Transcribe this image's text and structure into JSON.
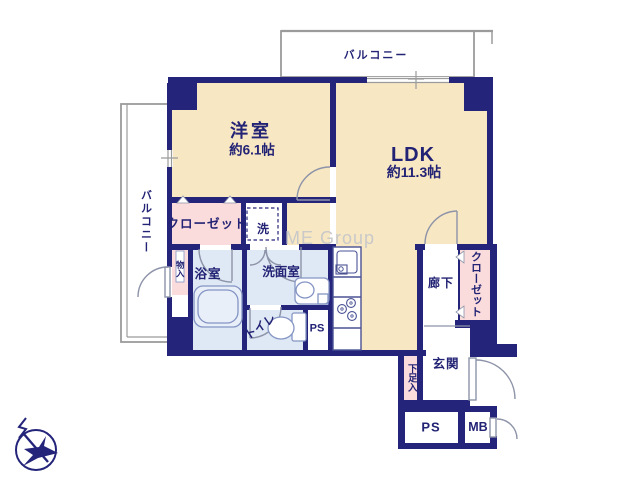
{
  "floorplan": {
    "rooms": {
      "western_room": {
        "label": "洋室",
        "size": "約6.1帖"
      },
      "ldk": {
        "label": "LDK",
        "size": "約11.3帖"
      },
      "balcony_top": {
        "label": "バルコニー"
      },
      "balcony_left": {
        "label": "バルコニー"
      },
      "closet_bedroom": {
        "label": "クローゼット"
      },
      "laundry": {
        "label": "洗"
      },
      "washroom": {
        "label": "洗面室"
      },
      "bathroom": {
        "label": "浴室"
      },
      "storage": {
        "label": "物入"
      },
      "toilet": {
        "label": "トイレ"
      },
      "pipe_space_mid": {
        "label": "PS"
      },
      "hallway": {
        "label": "廊下"
      },
      "closet_hallway": {
        "label": "クローゼット"
      },
      "entrance": {
        "label": "玄関"
      },
      "shoe_cabinet": {
        "label": "下足入"
      },
      "pipe_space_bottom": {
        "label": "PS"
      },
      "meter_box": {
        "label": "MB"
      }
    },
    "watermark": "ME Group",
    "colors": {
      "wall": "#24247a",
      "room_floor": "#f8e7c3",
      "closet_fill": "#fadcdc",
      "wet_area_fill": "#dfe9f5",
      "balcony_line": "#9b9b9b",
      "door_line": "#8d93a8",
      "fixture_line": "#8494c4",
      "label_text": "#232375",
      "watermark_text": "#c9c9c9"
    }
  }
}
